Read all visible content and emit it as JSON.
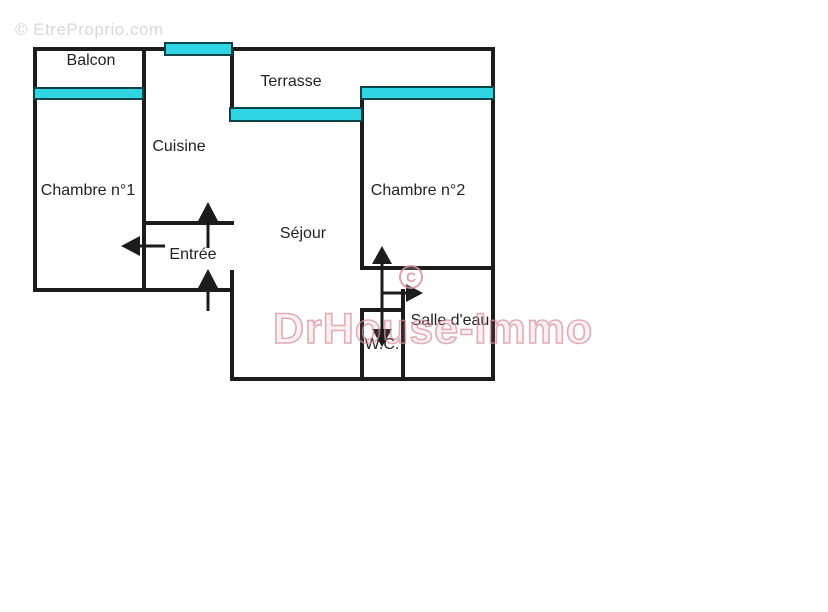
{
  "plan": {
    "rooms": {
      "balcon": "Balcon",
      "terrasse": "Terrasse",
      "cuisine": "Cuisine",
      "chambre1": "Chambre n°1",
      "chambre2": "Chambre n°2",
      "sejour": "Séjour",
      "entree": "Entrée",
      "salle_deau": "Salle d'eau",
      "wc": "W.C."
    }
  },
  "watermarks": {
    "top_left": "© EtreProprio.com",
    "center": "DrHouse-Immo",
    "copyright_symbol": "C"
  },
  "colors": {
    "wall": "#1c1c1c",
    "window": "#2fd5e2",
    "window_border": "#0e4447",
    "text": "#222222",
    "watermark_gray": "#d8d8d8",
    "watermark_pink": "#d6929e"
  }
}
